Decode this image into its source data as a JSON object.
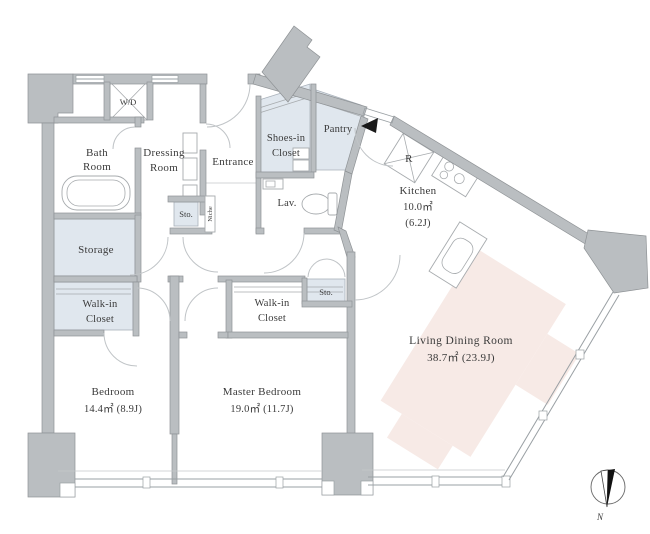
{
  "title": "apartment-floor-plan",
  "colors": {
    "wall_fill": "#babec1",
    "wall_stroke": "#8f9396",
    "tint_blue": "#e0e7ee",
    "tint_pink": "#f7eae6",
    "fixture_line": "#a7abae",
    "text": "#3a3a3a",
    "entry_marker": "#1a1a1a"
  },
  "rooms": {
    "wd": {
      "label": "W/D"
    },
    "bath": {
      "line1": "Bath",
      "line2": "Room"
    },
    "dressing": {
      "line1": "Dressing",
      "line2": "Room"
    },
    "entrance": {
      "label": "Entrance"
    },
    "shoes": {
      "line1": "Shoes-in",
      "line2": "Closet"
    },
    "pantry": {
      "label": "Pantry"
    },
    "lav": {
      "label": "Lav."
    },
    "fridge": {
      "label": "R"
    },
    "kitchen": {
      "line1": "Kitchen",
      "line2": "10.0㎡",
      "line3": "(6.2J)"
    },
    "storage": {
      "label": "Storage"
    },
    "sto_hall": {
      "label": "Sto."
    },
    "niche": {
      "label": "Niche"
    },
    "wic_bedroom": {
      "line1": "Walk-in",
      "line2": "Closet"
    },
    "wic_master": {
      "line1": "Walk-in",
      "line2": "Closet"
    },
    "sto_master": {
      "label": "Sto."
    },
    "bedroom": {
      "line1": "Bedroom",
      "line2": "14.4㎡ (8.9J)"
    },
    "master_bedroom": {
      "line1": "Master Bedroom",
      "line2": "19.0㎡ (11.7J)"
    },
    "living": {
      "line1": "Living Dining Room",
      "line2": "38.7㎡ (23.9J)"
    }
  },
  "compass": {
    "label": "N"
  }
}
